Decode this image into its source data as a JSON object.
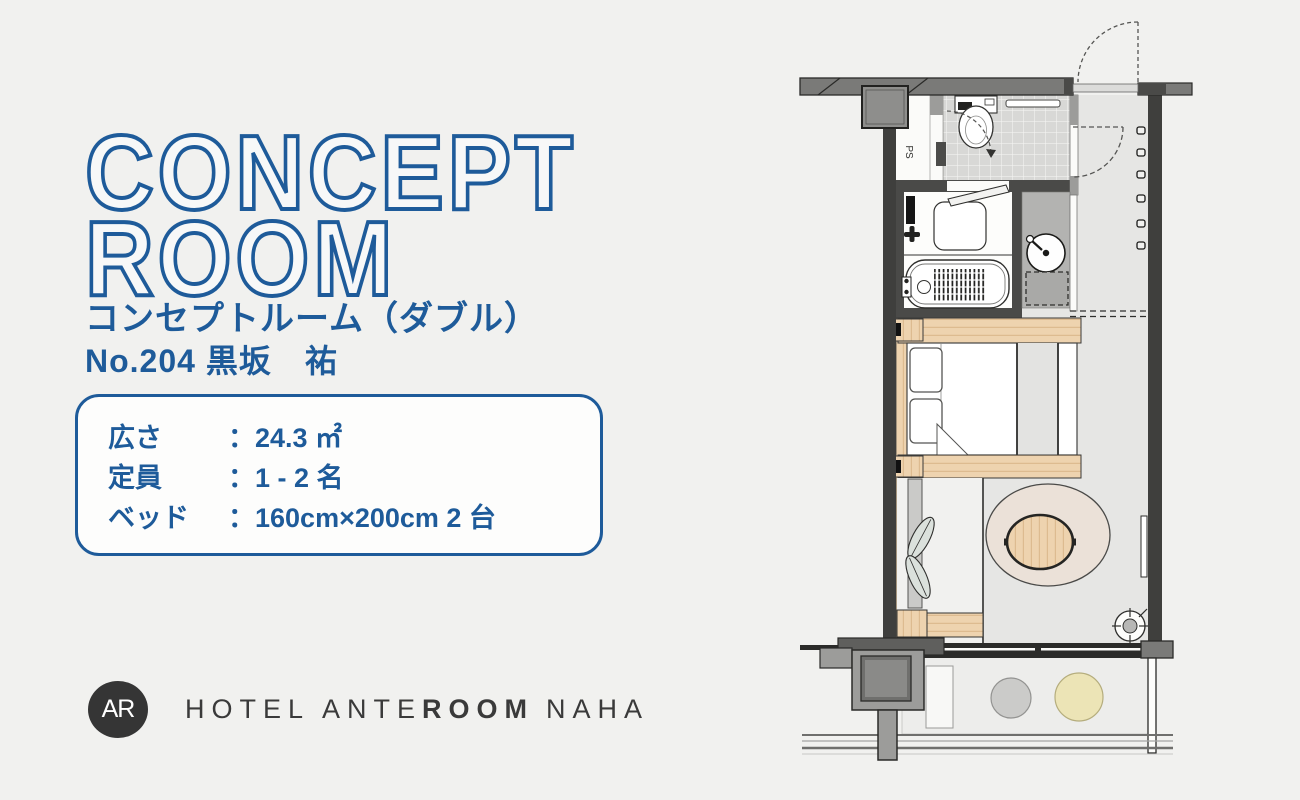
{
  "page": {
    "background": "#f1f1ef"
  },
  "colors": {
    "accent_blue": "#1e5b9a",
    "logo_dark": "#353535",
    "wall_dark": "#3f3f3d",
    "wood": "#eed3af",
    "rug": "#ebe1d8"
  },
  "header": {
    "title_line1": "CONCEPT",
    "title_line2": "ROOM",
    "subtitle": "コンセプトルーム（ダブル）",
    "room_no": "No.204 黒坂　祐"
  },
  "specs": {
    "separator": "：",
    "rows": [
      {
        "label": "広さ",
        "value": "24.3 ㎡"
      },
      {
        "label": "定員",
        "value": "1 - 2 名"
      },
      {
        "label": "ベッド",
        "value": "160cm×200cm 2 台"
      }
    ]
  },
  "footer": {
    "logo_monogram": "AR",
    "name_part1": "HOTEL ANTE",
    "name_part2": "ROOM",
    "name_part3": "NAHA"
  },
  "floorplan": {
    "ps_label": "PS"
  }
}
